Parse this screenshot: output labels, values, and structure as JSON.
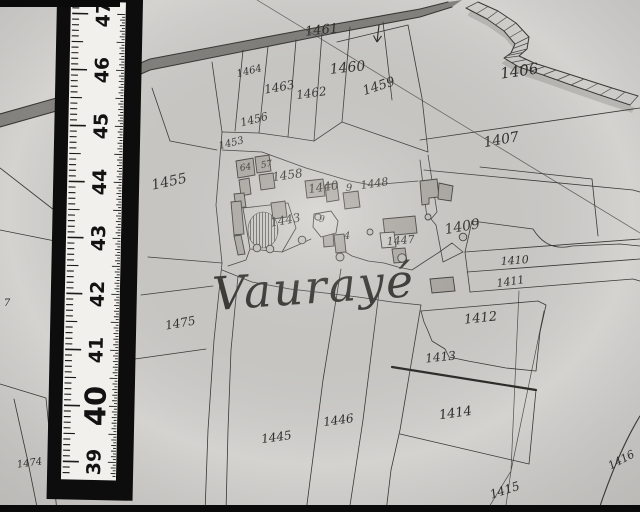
{
  "scene": {
    "kind": "cadastral-map-photograph",
    "colors": {
      "paper": "#d4d3d0",
      "ink": "#3a3835",
      "building_fill": "#b2afa9",
      "road_fill": "#7d7b77",
      "ruler_black": "#0d0d0d",
      "ruler_white": "#f1f0ec"
    }
  },
  "map": {
    "place_label": "Vaurayé",
    "north_arrow": "down-arrow",
    "parcel_labels": [
      {
        "text": "1461",
        "x": 322,
        "y": 34,
        "size": 13,
        "rot": -6
      },
      {
        "text": "1460",
        "x": 348,
        "y": 72,
        "size": 14,
        "rot": -6
      },
      {
        "text": "1459",
        "x": 380,
        "y": 90,
        "size": 13,
        "rot": -18
      },
      {
        "text": "1406",
        "x": 520,
        "y": 76,
        "size": 15,
        "rot": -8
      },
      {
        "text": "1407",
        "x": 502,
        "y": 144,
        "size": 14,
        "rot": -10
      },
      {
        "text": "1464",
        "x": 250,
        "y": 74,
        "size": 10,
        "rot": -14
      },
      {
        "text": "1463",
        "x": 280,
        "y": 91,
        "size": 12,
        "rot": -10
      },
      {
        "text": "1462",
        "x": 312,
        "y": 97,
        "size": 12,
        "rot": -8
      },
      {
        "text": "1456",
        "x": 255,
        "y": 123,
        "size": 11,
        "rot": -14
      },
      {
        "text": "1455",
        "x": 170,
        "y": 186,
        "size": 14,
        "rot": -12
      },
      {
        "text": "1453",
        "x": 232,
        "y": 146,
        "size": 10,
        "rot": -14
      },
      {
        "text": "64",
        "x": 246,
        "y": 170,
        "size": 9,
        "rot": -10
      },
      {
        "text": "57",
        "x": 267,
        "y": 167,
        "size": 9,
        "rot": -10
      },
      {
        "text": "1458",
        "x": 288,
        "y": 179,
        "size": 12,
        "rot": -8
      },
      {
        "text": "1440",
        "x": 324,
        "y": 191,
        "size": 12,
        "rot": -8
      },
      {
        "text": "9",
        "x": 349,
        "y": 191,
        "size": 10,
        "rot": 0
      },
      {
        "text": "9",
        "x": 322,
        "y": 222,
        "size": 9,
        "rot": 0
      },
      {
        "text": "1448",
        "x": 375,
        "y": 187,
        "size": 11,
        "rot": -8
      },
      {
        "text": "1447",
        "x": 401,
        "y": 244,
        "size": 11,
        "rot": -5
      },
      {
        "text": "1409",
        "x": 463,
        "y": 231,
        "size": 14,
        "rot": -10
      },
      {
        "text": "1443",
        "x": 286,
        "y": 224,
        "size": 12,
        "rot": -10
      },
      {
        "text": "4",
        "x": 347,
        "y": 239,
        "size": 10,
        "rot": 0
      },
      {
        "text": "1410",
        "x": 515,
        "y": 264,
        "size": 11,
        "rot": -4
      },
      {
        "text": "1411",
        "x": 511,
        "y": 285,
        "size": 11,
        "rot": -8
      },
      {
        "text": "1412",
        "x": 481,
        "y": 322,
        "size": 13,
        "rot": -6
      },
      {
        "text": "1413",
        "x": 441,
        "y": 361,
        "size": 12,
        "rot": -6
      },
      {
        "text": "1414",
        "x": 456,
        "y": 417,
        "size": 13,
        "rot": -8
      },
      {
        "text": "1416",
        "x": 623,
        "y": 463,
        "size": 11,
        "rot": -28
      },
      {
        "text": "1415",
        "x": 506,
        "y": 494,
        "size": 12,
        "rot": -18
      },
      {
        "text": "1446",
        "x": 339,
        "y": 424,
        "size": 12,
        "rot": -8
      },
      {
        "text": "1445",
        "x": 277,
        "y": 441,
        "size": 12,
        "rot": -8
      },
      {
        "text": "1475",
        "x": 181,
        "y": 327,
        "size": 12,
        "rot": -10
      },
      {
        "text": "1474",
        "x": 30,
        "y": 466,
        "size": 10,
        "rot": -8
      },
      {
        "text": "7",
        "x": 7,
        "y": 306,
        "size": 10,
        "rot": 0
      }
    ]
  },
  "ruler": {
    "unit_labels": [
      {
        "text": "47",
        "y": 14
      },
      {
        "text": "46",
        "y": 70
      },
      {
        "text": "45",
        "y": 126
      },
      {
        "text": "44",
        "y": 182
      },
      {
        "text": "43",
        "y": 238
      },
      {
        "text": "42",
        "y": 294
      },
      {
        "text": "41",
        "y": 350
      },
      {
        "text": "40",
        "y": 406,
        "emphasis": true
      },
      {
        "text": "39",
        "y": 462
      }
    ]
  }
}
